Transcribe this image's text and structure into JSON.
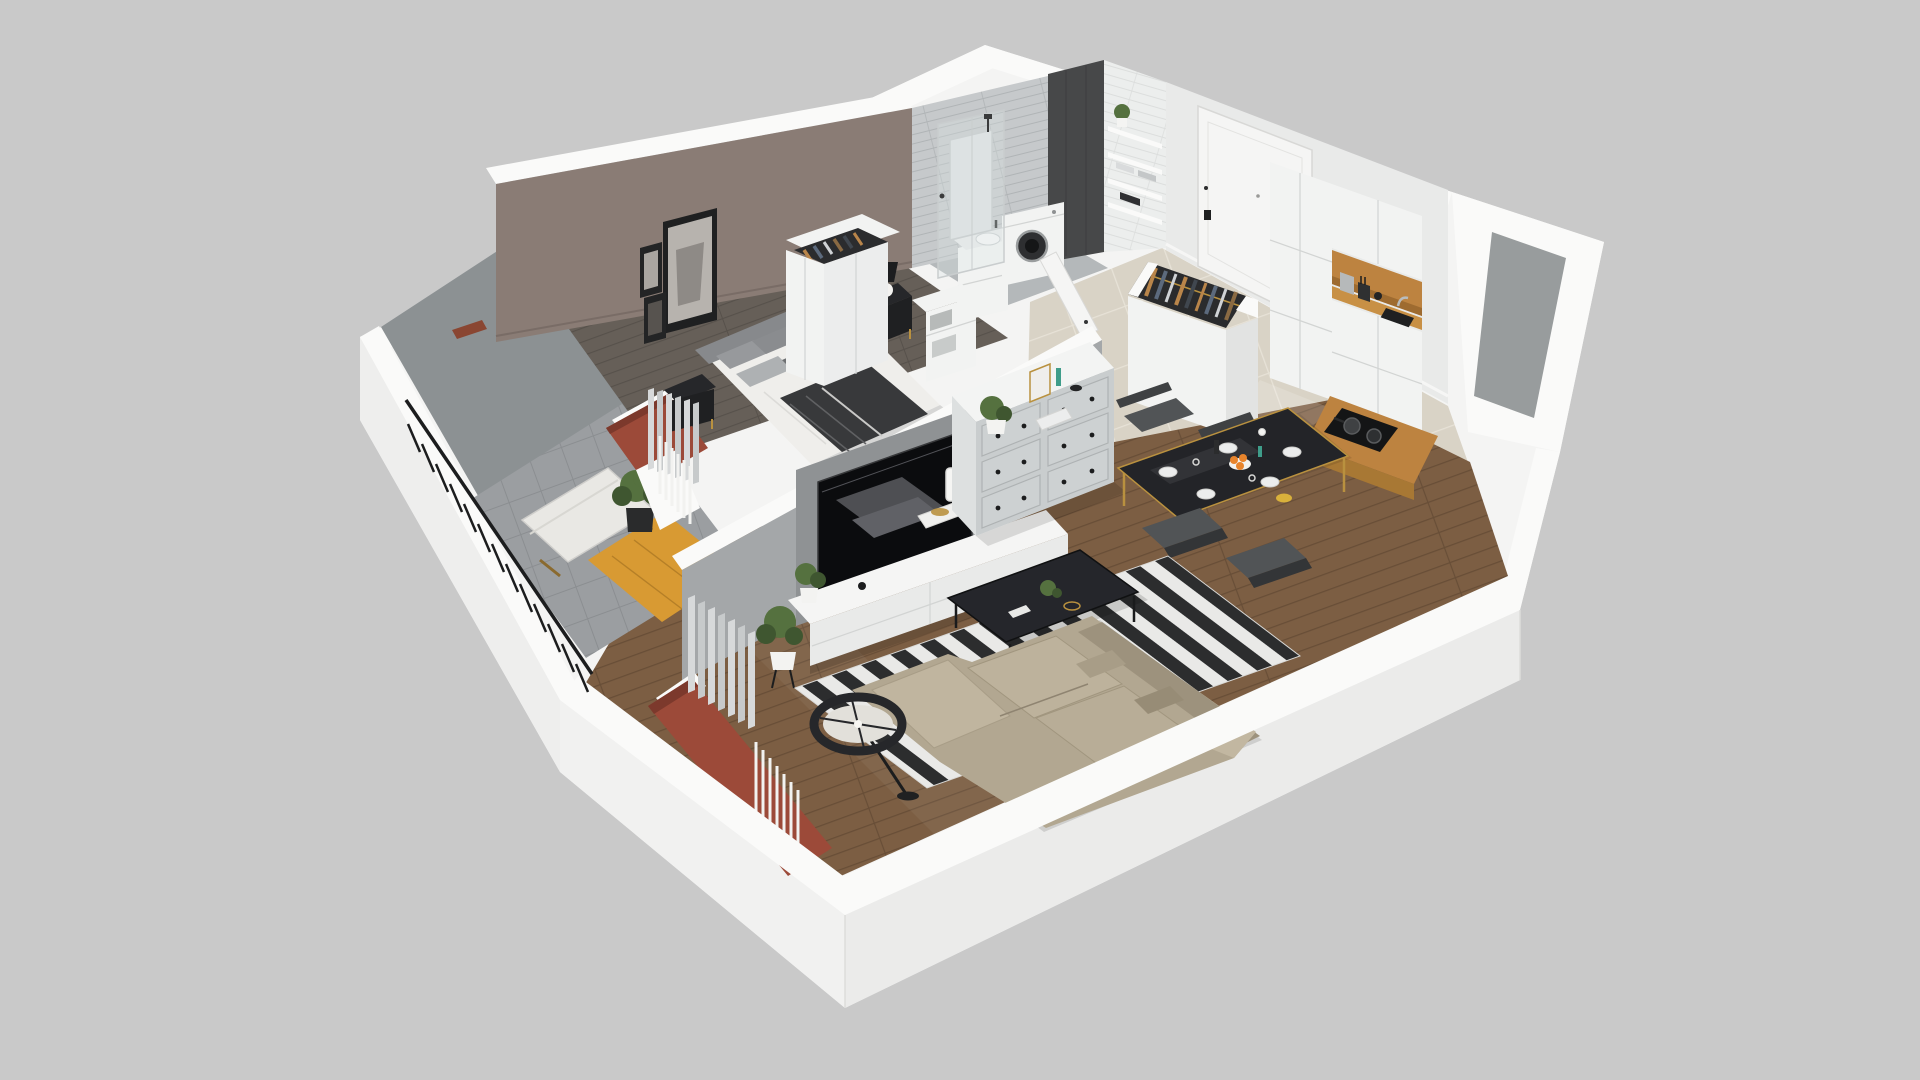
{
  "scene": {
    "label": "3D isometric cutaway render of a one-bedroom apartment floor plan",
    "type": "3d-floorplan-render",
    "view": "isometric-cutaway",
    "rooms": [
      {
        "name": "bedroom",
        "items": [
          "double-bed",
          "gray-pillows",
          "dark-throw",
          "nightstand",
          "table-lamp",
          "wardrobe-open-clothes",
          "storage-boxes",
          "wall-art-frames",
          "curtains",
          "radiator",
          "mauve-accent-wall"
        ]
      },
      {
        "name": "bathroom",
        "items": [
          "walk-in-shower",
          "glass-screen",
          "mirror",
          "washing-machine",
          "sink-vanity",
          "wall-shelves",
          "plant",
          "towels",
          "gray-subway-tile",
          "charcoal-tile-column",
          "white-tile-wall",
          "door-ajar"
        ]
      },
      {
        "name": "entry-hall",
        "items": [
          "front-door",
          "open-wardrobe-hanging-clothes",
          "beige-gloss-tile-floor"
        ]
      },
      {
        "name": "kitchen",
        "items": [
          "tall-white-cabinets",
          "oak-open-niche",
          "oak-countertop",
          "black-sink",
          "faucet",
          "kettle",
          "knife-block",
          "induction-cooktop",
          "two-pans",
          "base-cabinets"
        ]
      },
      {
        "name": "living-room",
        "items": [
          "wall-mounted-tv",
          "gray-tv-panel",
          "white-media-bench",
          "table-lamp",
          "books",
          "potted-plants",
          "black-white-striped-rug",
          "black-coffee-table",
          "beige-corner-sofa",
          "throw-pillows",
          "black-drum-floor-lamp",
          "white-gray-dresser-six-drawers",
          "decor-frame-vases",
          "curtains",
          "radiator",
          "wood-plank-floor"
        ]
      },
      {
        "name": "dining-area",
        "items": [
          "black-glass-table-gold-frame",
          "four-dark-chairs",
          "plates",
          "bowl-of-oranges",
          "glasses",
          "vases"
        ]
      },
      {
        "name": "balcony",
        "items": [
          "black-slat-railing",
          "wood-bench-white-cushion",
          "plant-on-black-stand",
          "orange-wood-deck",
          "gray-tile-floor",
          "brick-red-window-sills",
          "gray-outer-wall"
        ]
      }
    ]
  },
  "colors": {
    "bg": "#c9c9c9",
    "wall_cap": "#fafaf9",
    "wall_face_light": "#f4f4f3",
    "wall_inner_gray": "#a4a7a9",
    "balcony_wall": "#8c9193",
    "mauve": "#8a7c75",
    "tile_gray": "#c6c9cb",
    "tile_dark": "#474849",
    "tile_white": "#eceeed",
    "floor_tile": "#d9d3c6",
    "floor_tile_line": "#e7e2d7",
    "floor_wood": "#7c5e43",
    "floor_wood_line": "#684e37",
    "floor_wood_dark": "#665f58",
    "balcony_floor": "#9b9ea1",
    "deck": "#d89a33",
    "accent_red": "#9c4a39",
    "black": "#222325",
    "furn_white": "#f2f3f2",
    "furn_gray": "#c9cdce",
    "wood": "#bd8340",
    "gold": "#b9913f",
    "sofa": "#b2a791",
    "rug_white": "#e9e9e7",
    "rug_black": "#2c2d2e",
    "plant": "#55713f",
    "plant_dark": "#3f5630",
    "curtain": "#d7d9da",
    "chair": "#515456",
    "orange": "#e8842c",
    "teal": "#3f9d8a"
  }
}
